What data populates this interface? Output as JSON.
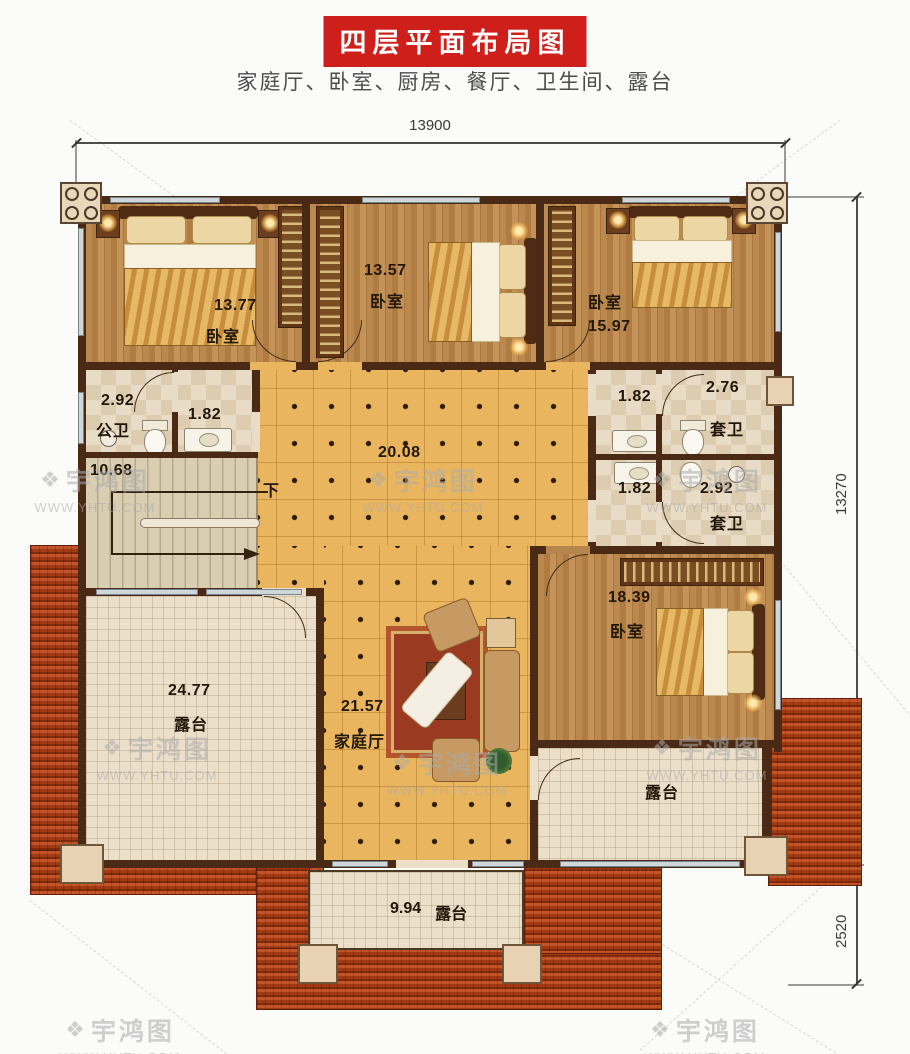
{
  "header": {
    "title": "四层平面布局图",
    "subtitle": "家庭厅、卧室、厨房、餐厅、卫生间、露台"
  },
  "dimensions": {
    "top": "13900",
    "right": "13270",
    "bottom_right": "2520"
  },
  "rooms": {
    "bedroom_top_left": {
      "name": "卧室",
      "area": "13.77"
    },
    "bedroom_top_mid": {
      "name": "卧室",
      "area": "13.57"
    },
    "bedroom_top_right": {
      "name": "卧室",
      "area": "15.97"
    },
    "bedroom_bottom_right": {
      "name": "卧室",
      "area": "18.39"
    },
    "public_bath": {
      "name": "公卫",
      "area": "2.92"
    },
    "public_bath_vanity": {
      "area": "1.82"
    },
    "stairs": {
      "area": "10.68",
      "down": "下"
    },
    "hall": {
      "area": "20.08"
    },
    "ensuite_top": {
      "name": "套卫",
      "area": "2.76"
    },
    "ensuite_top_vanity": {
      "area": "1.82"
    },
    "ensuite_bottom": {
      "name": "套卫",
      "area": "2.92"
    },
    "ensuite_bottom_vanity": {
      "area": "1.82"
    },
    "family_hall": {
      "name": "家庭厅",
      "area": "21.57"
    },
    "terrace_left": {
      "name": "露台",
      "area": "24.77"
    },
    "terrace_right": {
      "name": "露台"
    },
    "terrace_bottom": {
      "name": "露台",
      "area": "9.94"
    }
  },
  "watermark": {
    "brand": "宇鸿图",
    "url": "WWW.YHTU.COM"
  },
  "colors": {
    "banner_red": "#ce1f1a",
    "wall_brown": "#4a2a15",
    "roof_red": "#b5451f",
    "hall_tile": "#eab55f"
  }
}
